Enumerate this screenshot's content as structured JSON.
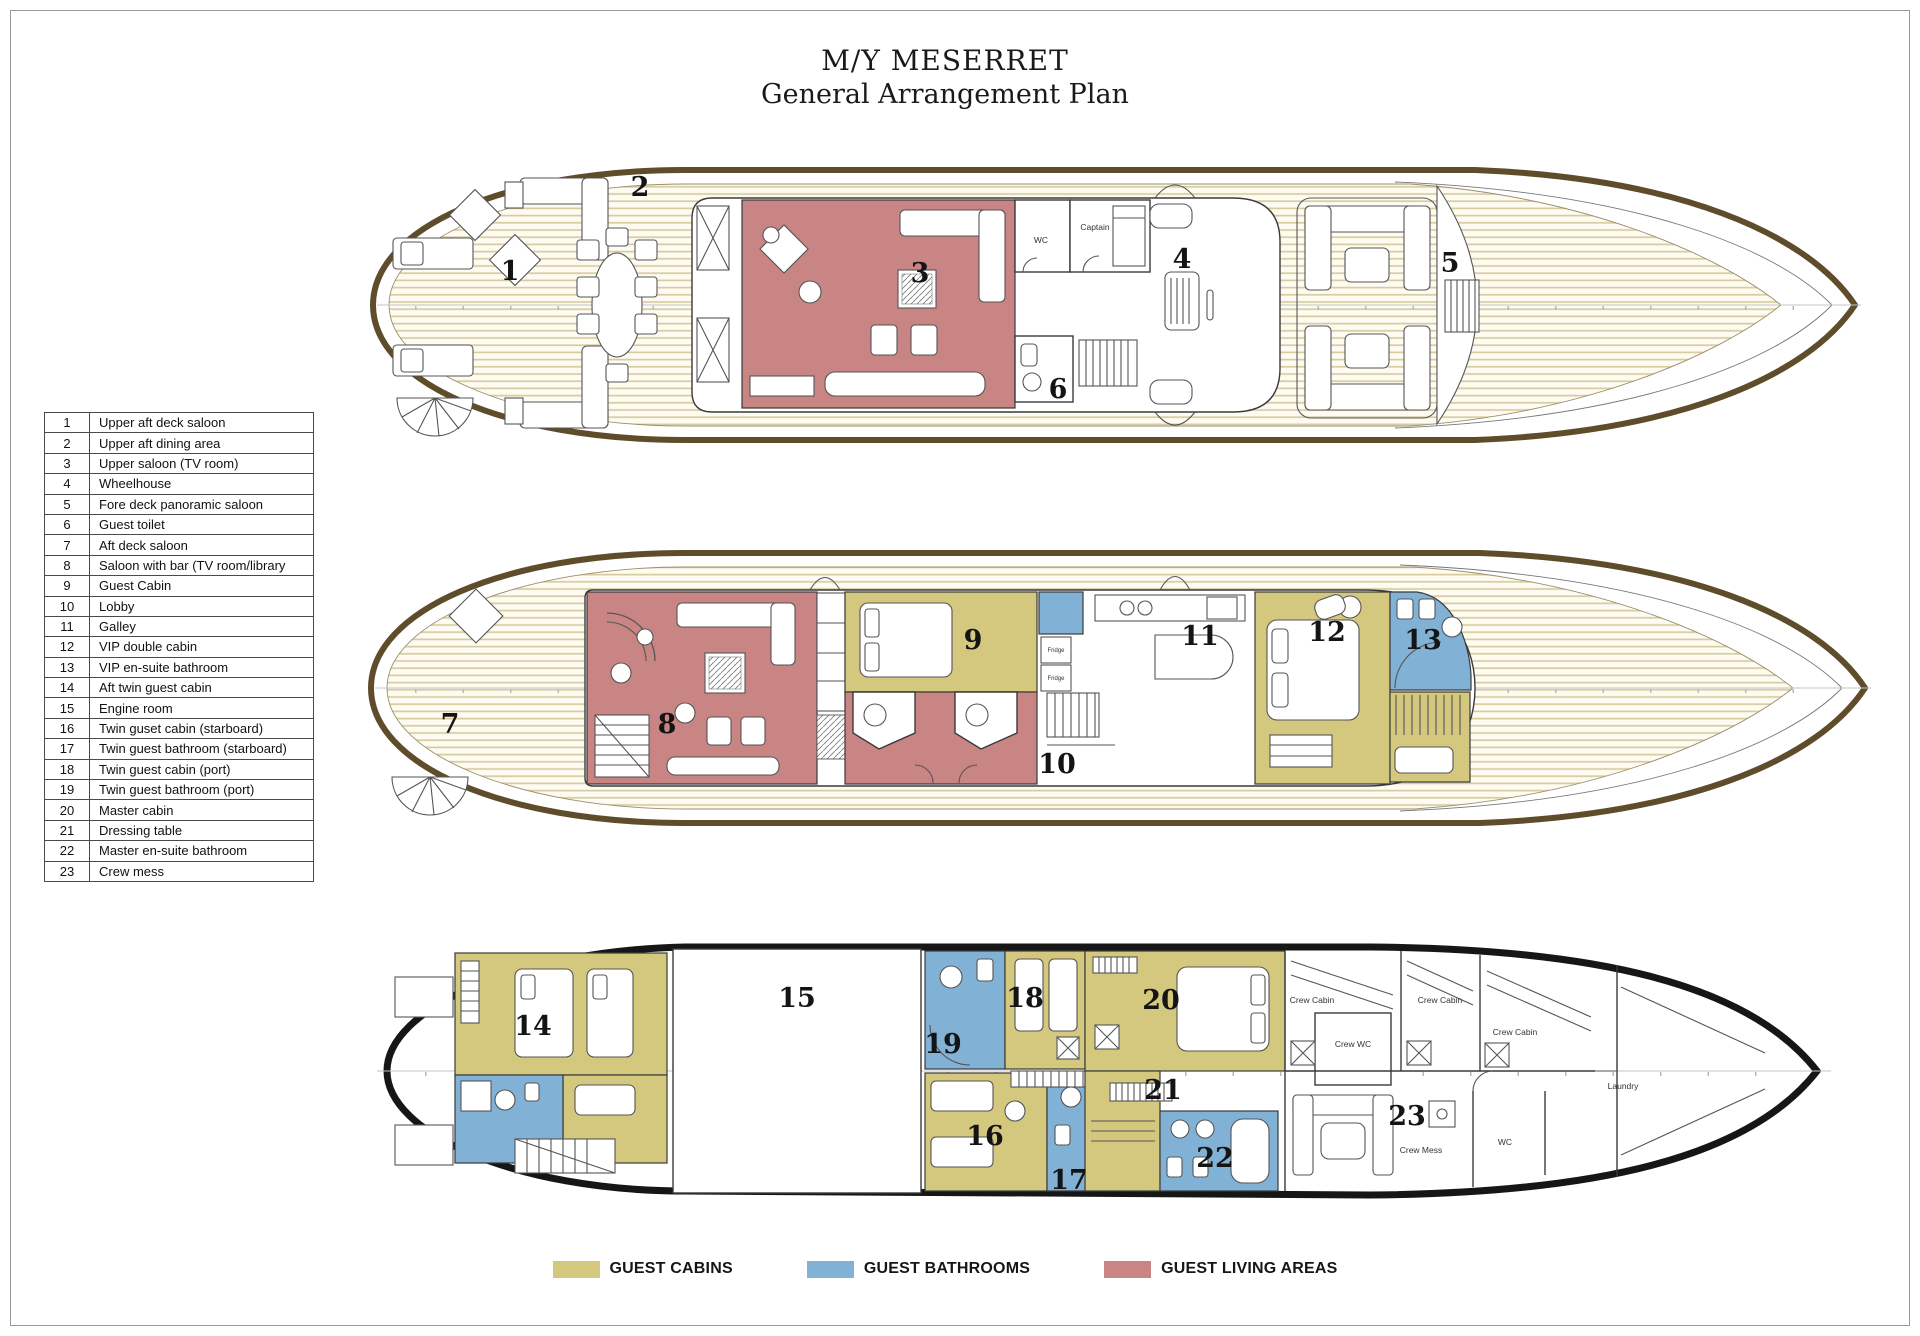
{
  "title": {
    "line1": "M/Y MESERRET",
    "line2": "General Arrangement Plan"
  },
  "legend_table": [
    {
      "num": "1",
      "label": "Upper aft deck saloon"
    },
    {
      "num": "2",
      "label": "Upper aft dining area"
    },
    {
      "num": "3",
      "label": "Upper saloon (TV room)"
    },
    {
      "num": "4",
      "label": "Wheelhouse"
    },
    {
      "num": "5",
      "label": "Fore deck panoramic saloon"
    },
    {
      "num": "6",
      "label": "Guest toilet"
    },
    {
      "num": "7",
      "label": "Aft deck saloon"
    },
    {
      "num": "8",
      "label": "Saloon with bar (TV room/library"
    },
    {
      "num": "9",
      "label": "Guest Cabin"
    },
    {
      "num": "10",
      "label": "Lobby"
    },
    {
      "num": "11",
      "label": "Galley"
    },
    {
      "num": "12",
      "label": "VIP double cabin"
    },
    {
      "num": "13",
      "label": "VIP en-suite bathroom"
    },
    {
      "num": "14",
      "label": "Aft twin guest cabin"
    },
    {
      "num": "15",
      "label": "Engine room"
    },
    {
      "num": "16",
      "label": "Twin guset cabin (starboard)"
    },
    {
      "num": "17",
      "label": "Twin guest bathroom (starboard)"
    },
    {
      "num": "18",
      "label": "Twin guest cabin (port)"
    },
    {
      "num": "19",
      "label": "Twin guest bathroom (port)"
    },
    {
      "num": "20",
      "label": "Master cabin"
    },
    {
      "num": "21",
      "label": "Dressing table"
    },
    {
      "num": "22",
      "label": "Master en-suite bathroom"
    },
    {
      "num": "23",
      "label": "Crew mess"
    }
  ],
  "color_legend": [
    {
      "label": "GUEST CABINS",
      "color": "#d3c87e"
    },
    {
      "label": "GUEST BATHROOMS",
      "color": "#81b1d5"
    },
    {
      "label": "GUEST LIVING AREAS",
      "color": "#c98484"
    }
  ],
  "decks": {
    "upper": {
      "numbers": [
        "1",
        "2",
        "3",
        "4",
        "5",
        "6"
      ],
      "labels": {
        "wc": "WC",
        "captain": "Captain"
      }
    },
    "main": {
      "numbers": [
        "7",
        "8",
        "9",
        "10",
        "11",
        "12",
        "13"
      ],
      "labels": {
        "fridge1": "Fridge",
        "fridge2": "Fridge"
      }
    },
    "lower": {
      "numbers": [
        "14",
        "15",
        "16",
        "17",
        "18",
        "19",
        "20",
        "21",
        "22",
        "23"
      ],
      "labels": {
        "crew_cabin1": "Crew Cabin",
        "crew_wc": "Crew WC",
        "crew_cabin2": "Crew Cabin",
        "crew_cabin3": "Crew Cabin",
        "laundry": "Laundry",
        "crew_mess": "Crew Mess",
        "wc": "WC"
      }
    }
  }
}
